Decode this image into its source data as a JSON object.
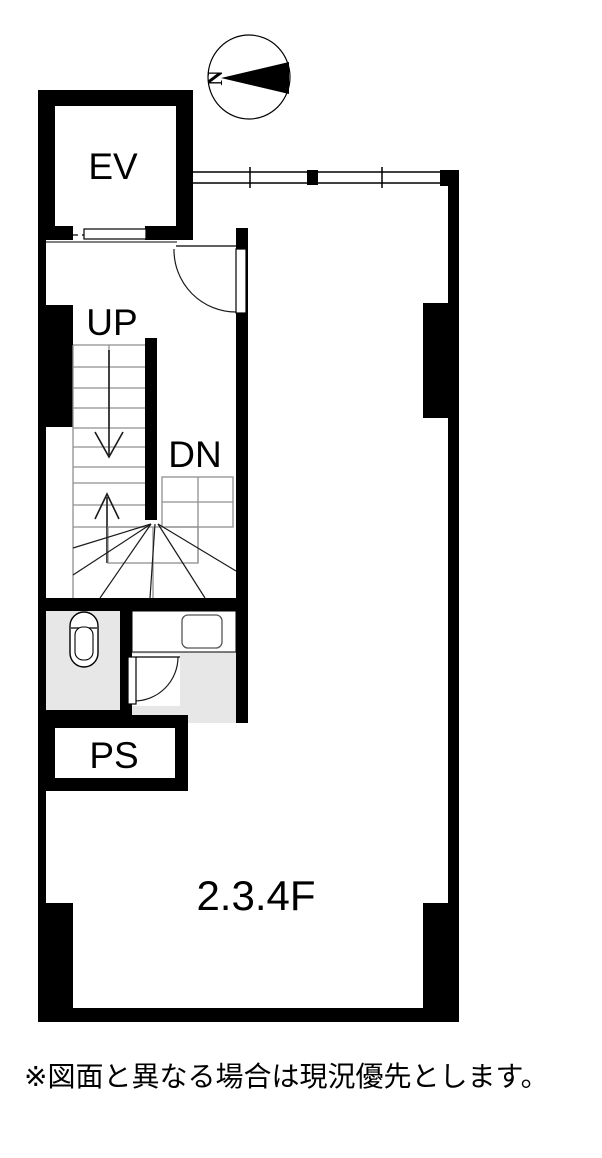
{
  "compass": {
    "north_label": "N"
  },
  "labels": {
    "elevator": "EV",
    "stairs_up": "UP",
    "stairs_down": "DN",
    "pipe_shaft": "PS",
    "floor": "2.3.4F"
  },
  "note": "※図面と異なる場合は現況優先とします。",
  "colors": {
    "wall": "#000000",
    "line": "#1a1a1a",
    "stair_tread": "#8f8f8f",
    "room_fill": "#e7e7e7",
    "background": "#ffffff"
  }
}
